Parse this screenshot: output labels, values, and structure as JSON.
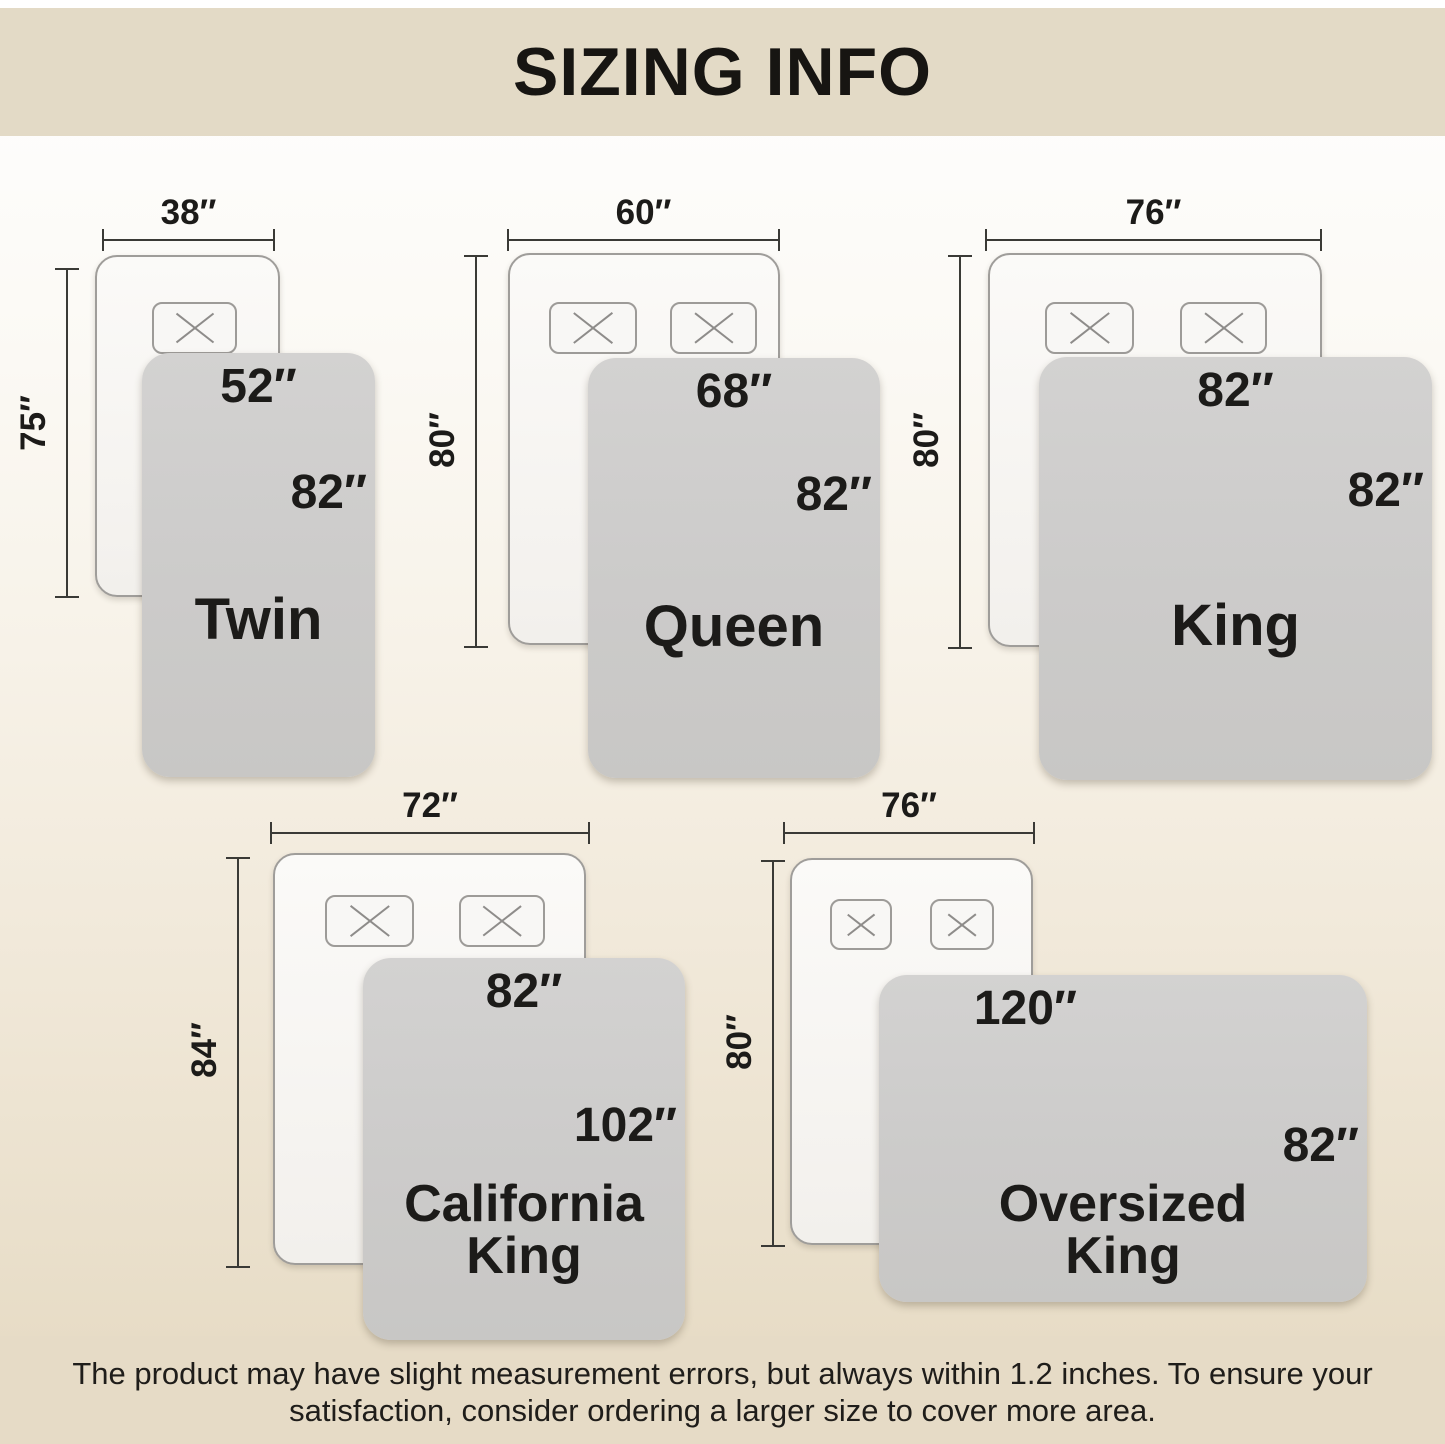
{
  "header": {
    "title": "SIZING INFO"
  },
  "footer": {
    "disclaimer": "The product may have slight measurement errors, but always within 1.2 inches. To ensure your\nsatisfaction, consider ordering a larger size to cover more area."
  },
  "units_note": "inches shown with double-prime marks",
  "colors": {
    "banner": "#e3dac6",
    "background_bottom": "#e6dbc5",
    "blanket_gray": "#cccbca",
    "bed_white": "#f8f6f3",
    "dimension_line": "#3a3a36",
    "text": "#1c1b19"
  },
  "sizes": [
    {
      "id": "twin",
      "name": "Twin",
      "bed_width": "38″",
      "bed_length": "75″",
      "blanket_width": "52″",
      "blanket_length": "82″",
      "pillow_count": 1
    },
    {
      "id": "queen",
      "name": "Queen",
      "bed_width": "60″",
      "bed_length": "80″",
      "blanket_width": "68″",
      "blanket_length": "82″",
      "pillow_count": 2
    },
    {
      "id": "king",
      "name": "King",
      "bed_width": "76″",
      "bed_length": "80″",
      "blanket_width": "82″",
      "blanket_length": "82″",
      "pillow_count": 2
    },
    {
      "id": "california-king",
      "name": "California\nKing",
      "bed_width": "72″",
      "bed_length": "84″",
      "blanket_width": "82″",
      "blanket_length": "102″",
      "pillow_count": 2
    },
    {
      "id": "oversized-king",
      "name": "Oversized\nKing",
      "bed_width": "76″",
      "bed_length": "80″",
      "blanket_width": "120″",
      "blanket_length": "82″",
      "pillow_count": 2
    }
  ]
}
